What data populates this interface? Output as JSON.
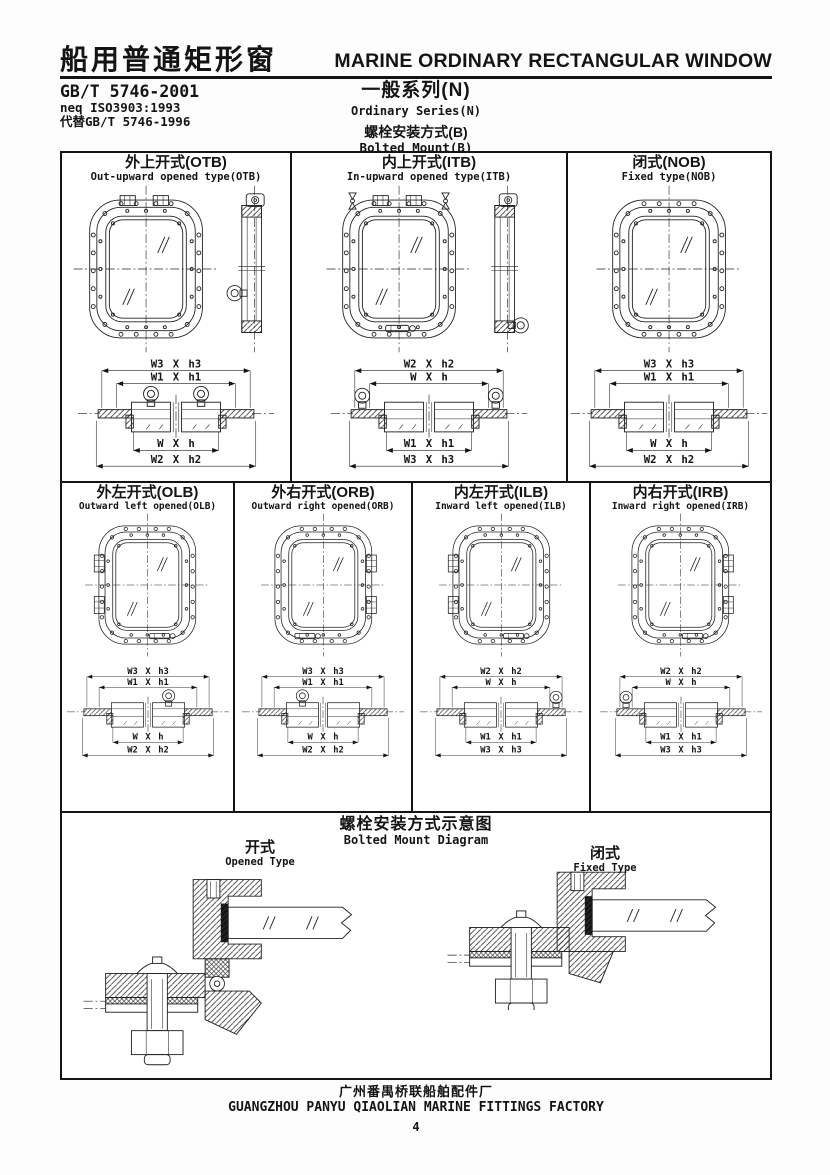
{
  "page": {
    "title_zh": "船用普通矩形窗",
    "title_en": "MARINE ORDINARY RECTANGULAR WINDOW",
    "standard_no": "GB/T 5746-2001",
    "standard_neq": "neq ISO3903:1993",
    "standard_replaces": "代替GB/T 5746-1996",
    "series_zh": "一般系列(N)",
    "series_en": "Ordinary Series(N)",
    "mount_zh": "螺栓安装方式(B)",
    "mount_en": "Bolted Mount(B)"
  },
  "row1": [
    {
      "title_zh": "外上开式(OTB)",
      "title_en": "Out-upward opened type(OTB)",
      "dims_top": [
        "W3 X h3",
        "W1 X h1"
      ],
      "dims_bottom": [
        "W X h",
        "W2 X h2"
      ]
    },
    {
      "title_zh": "内上开式(ITB)",
      "title_en": "In-upward opened type(ITB)",
      "dims_top": [
        "W2 X h2",
        "W X h"
      ],
      "dims_bottom": [
        "W1 X h1",
        "W3 X h3"
      ]
    },
    {
      "title_zh": "闭式(NOB)",
      "title_en": "Fixed type(NOB)",
      "dims_top": [
        "W3 X h3",
        "W1 X h1"
      ],
      "dims_bottom": [
        "W X h",
        "W2 X h2"
      ]
    }
  ],
  "row2": [
    {
      "title_zh": "外左开式(OLB)",
      "title_en": "Outward left opened(OLB)",
      "dims_top": [
        "W3 X h3",
        "W1 X h1"
      ],
      "dims_bottom": [
        "W X h",
        "W2 X h2"
      ]
    },
    {
      "title_zh": "外右开式(ORB)",
      "title_en": "Outward right opened(ORB)",
      "dims_top": [
        "W3 X h3",
        "W1 X h1"
      ],
      "dims_bottom": [
        "W X h",
        "W2 X h2"
      ]
    },
    {
      "title_zh": "内左开式(ILB)",
      "title_en": "Inward left opened(ILB)",
      "dims_top": [
        "W2 X h2",
        "W X h"
      ],
      "dims_bottom": [
        "W1 X h1",
        "W3 X h3"
      ]
    },
    {
      "title_zh": "内右开式(IRB)",
      "title_en": "Inward right opened(IRB)",
      "dims_top": [
        "W2 X h2",
        "W X h"
      ],
      "dims_bottom": [
        "W1 X h1",
        "W3 X h3"
      ]
    }
  ],
  "diagram_section": {
    "title_zh": "螺栓安装方式示意图",
    "title_en": "Bolted Mount Diagram",
    "opened_zh": "开式",
    "opened_en": "Opened Type",
    "fixed_zh": "闭式",
    "fixed_en": "Fixed Type"
  },
  "footer": {
    "factory_zh": "广州番禺桥联船舶配件厂",
    "factory_en": "GUANGZHOU PANYU QIAOLIAN MARINE FITTINGS FACTORY",
    "page_number": "4"
  },
  "colors": {
    "ink": "#141414",
    "paper": "#ffffff"
  }
}
